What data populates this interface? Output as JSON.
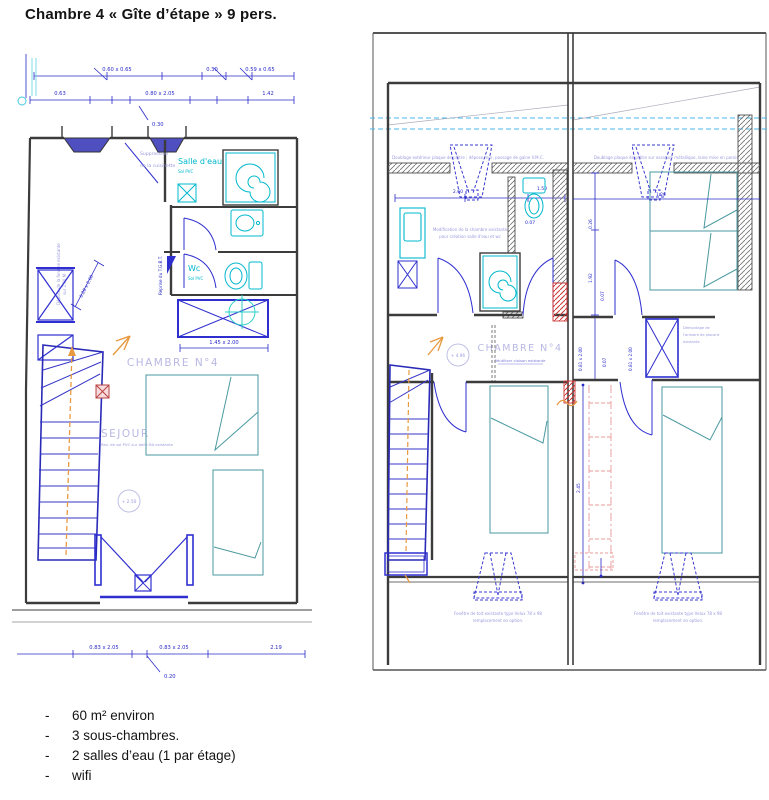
{
  "title": "Chambre 4 « Gîte d’étape » 9 pers.",
  "list_marker": "-",
  "bullets": [
    "60 m² environ",
    "3 sous-chambres.",
    "2 salles d’eau (1 par étage)",
    "wifi"
  ],
  "colors": {
    "cad_blue": "#2a2ac8",
    "cad_cyan": "#00b8cc",
    "bed_teal": "#4a9aa0",
    "wall_gray": "#3c3c3c",
    "note_purple": "#9a9ade",
    "accent_orange": "#e89a40",
    "accent_red": "#cc3333",
    "dash_cyan": "#44b8e8"
  },
  "plan_left": {
    "dim_top1_a": "0.60 x 0.65",
    "dim_top1_b": "0.30",
    "dim_top1_c": "0.59 x 0.65",
    "dim_top2_a": "0.63",
    "dim_top2_b": "0.80 x 2.05",
    "dim_top2_c": "1.42",
    "dim_leader_top": "0.30",
    "dim_window": "0.28 x 2.00",
    "dim_closet": "1.45 x 2.00",
    "dim_bot_a": "0.83 x 2.05",
    "dim_bot_b": "0.83 x 2.05",
    "dim_bot_c": "2.19",
    "dim_bot_leader": "0.20",
    "salle_eau": "Salle d'eau",
    "salle_eau_sub": "Sol PVC",
    "wc": "Wc",
    "wc_sub": "Sol PVC",
    "tgbt": "Reprise du T.G.B.T.",
    "note_cuisinette_1": "Suppression",
    "note_cuisinette_2": "de la cuisinette",
    "note_fenetre_1": "Dépose de la fenêtre existante",
    "note_fenetre_2": "sur 2.00 M",
    "chambre": "CHAMBRE N°4",
    "sejour": "SEJOUR",
    "sejour_sub": "Rev. de sol PVC sur dalle BA existante",
    "niveau": "+ 2.50"
  },
  "plan_right": {
    "note_doublage_left": "Doublage extérieur plaque de plâtre ; dépose mur, passage de gaine V.M.C.",
    "note_doublage_right": "Doublage plaque de plâtre sur ossature métallique, laine mise en parois",
    "note_modif_1": "Modification de la chambre existante",
    "note_modif_2": "pour création salle d'eau et wc",
    "chambre": "CHAMBRE N°4",
    "chambre_sub": "Réutiliser cloison existante",
    "niveau": "+ 4.96",
    "note_placard_1": "Démontage de",
    "note_placard_2": "l'armoire de placard",
    "note_placard_3": "existante",
    "note_velux_1": "Fenêtre de toit existante type Velux 78 x 98",
    "note_velux_2": "remplacement en option.",
    "dim_260": "2.60",
    "dim_150": "1.50",
    "dim_007": "0.07",
    "dim_026": "0.26",
    "dim_192": "1.92",
    "dim_120": "1.20",
    "dim_081": "0.81 x 2.00",
    "dim_245": "2.45"
  }
}
